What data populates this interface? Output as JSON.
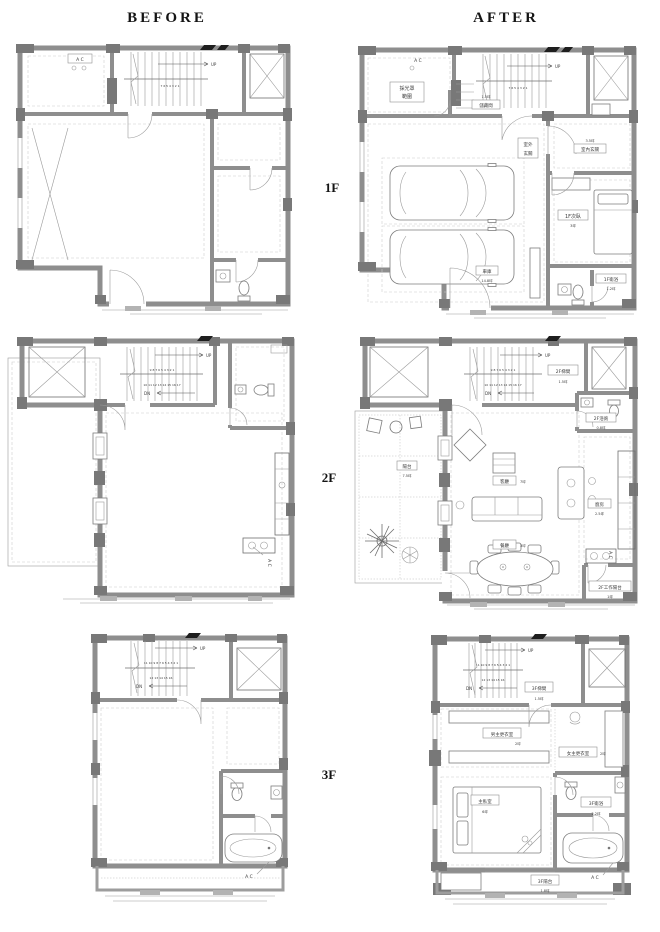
{
  "header": {
    "before": "BEFORE",
    "after": "AFTER"
  },
  "floors": {
    "f1": "1F",
    "f2": "2F",
    "f3": "3F"
  },
  "b1f": {
    "ac": "A C",
    "up": "UP",
    "nums": "7 6 5 4 3 2 1"
  },
  "a1f": {
    "ac": "A C",
    "up": "UP",
    "nums": "7 6 5 4 3 2 1",
    "skylight1": "採光罩",
    "skylight2": "範圍",
    "storage_area": "1.5坪",
    "storage": "儲藏間",
    "garage": "車庫",
    "garage_area": "14.8坪",
    "foyer_out1": "室外",
    "foyer_out2": "玄關",
    "foyer_in_area": "3.5坪",
    "foyer_in": "室內玄關",
    "bedroom": "1F次臥",
    "bedroom_area": "3坪",
    "bath": "1F衛浴",
    "bath_area": "1.2坪"
  },
  "b2f": {
    "ac": "A C",
    "up": "UP",
    "dn": "DN",
    "nums1": "9 8 7 6 5 4 3 2 1",
    "nums2": "10 11 12 13 14 15 16 17"
  },
  "a2f": {
    "ac": "A C",
    "up": "UP",
    "dn": "DN",
    "nums1": "9 8 7 6 5 4 3 2 1",
    "nums2": "10 11 12 13 14 15 16 17",
    "stairwell": "2F梯間",
    "stairwell_area": "1.5坪",
    "bath": "2F浴廁",
    "bath_area": "0.8坪",
    "balcony": "陽台",
    "balcony_area": "7.5坪",
    "living": "客廳",
    "living_area": "7坪",
    "dining": "餐廳",
    "dining_area": "3坪",
    "kitchen": "廚房",
    "kitchen_area": "2.5坪",
    "work_balcony": "2F工作陽台",
    "work_balcony_area": "1坪"
  },
  "b3f": {
    "ac": "A C",
    "up": "UP",
    "dn": "DN",
    "nums1": "11 10 9 8 7 6 5 4 3 2 1",
    "nums2": "12 13 14 15 16"
  },
  "a3f": {
    "ac": "A C",
    "up": "UP",
    "dn": "DN",
    "nums1": "11 10 9 8 7 6 5 4 3 2 1",
    "nums2": "12 13 14 15 16",
    "stairwell": "3F梯間",
    "stairwell_area": "1.5坪",
    "closet_m": "男主更衣室",
    "closet_m_area": "2坪",
    "closet_f": "女主更衣室",
    "closet_f_area": "2坪",
    "master": "主臥室",
    "master_area": "6坪",
    "bath": "3F衛浴",
    "bath_area": "2.2坪",
    "balcony": "3F陽台",
    "balcony_area": "1.8坪"
  }
}
